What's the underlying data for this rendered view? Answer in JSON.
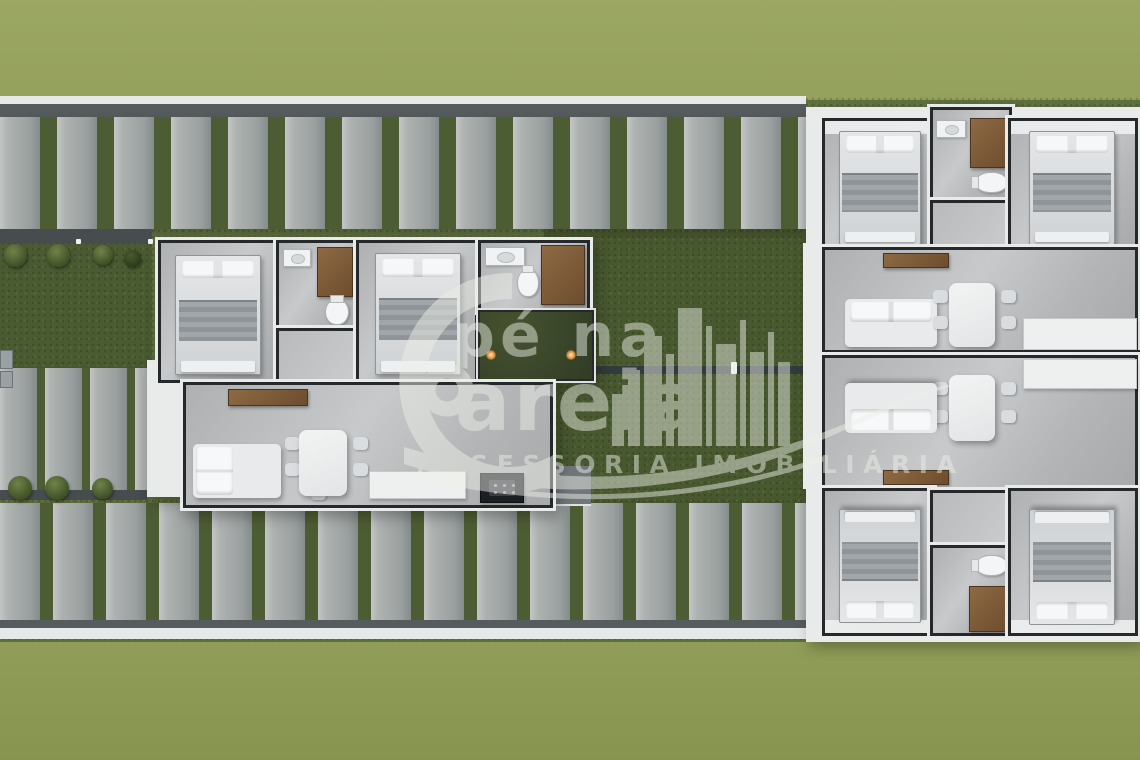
{
  "watermark": {
    "brand_line1": "pé na",
    "brand_line2": "areia",
    "subtitle": "ASSESSORIA IMOBILIÁRIA",
    "logo_icon": "city-skyline-wave-logo",
    "text_color": "#eef0e9"
  },
  "palette": {
    "grass_light": "#94a15d",
    "grass_mid": "#5f7040",
    "grass_dark": "#48582f",
    "slat_gray": "#aeb2b1",
    "wall_white": "#e9ebea",
    "wall_dark": "#26292b",
    "floor_gray": "#b6b8ba",
    "wood_brown": "#7d5c39",
    "counter_black": "#1c1f21",
    "garden_light_orange": "#cf843a"
  },
  "site": {
    "top_pergola_slats": 14,
    "bottom_pergola_slats": 15,
    "left_pergola_slats": 4,
    "bush_count": 7,
    "courtyard_light_count": 2
  }
}
